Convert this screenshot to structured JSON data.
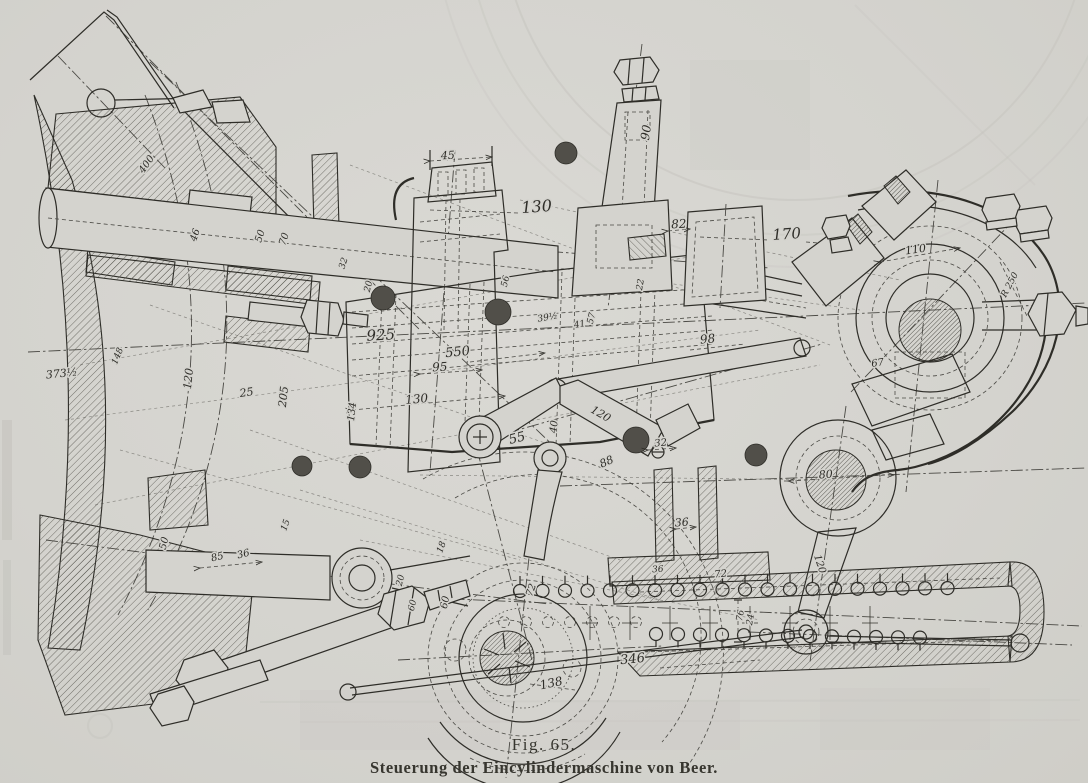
{
  "figure": {
    "number": "Fig. 65.",
    "caption": "Steuerung der Eincylindermaschine von Beer."
  },
  "colors": {
    "paper": "#d4d3ce",
    "ink": "#2e2d28",
    "faint": "#bcbbb4"
  },
  "diagram": {
    "type": "technical-drawing",
    "dimension_labels": [
      {
        "t": "45",
        "x": 448,
        "y": 159,
        "r": -3,
        "s": 11
      },
      {
        "t": "130",
        "x": 537,
        "y": 212,
        "r": -4,
        "s": 16
      },
      {
        "t": "82",
        "x": 679,
        "y": 228,
        "r": -3,
        "s": 12
      },
      {
        "t": "90",
        "x": 650,
        "y": 133,
        "r": -82,
        "s": 12
      },
      {
        "t": "170",
        "x": 787,
        "y": 239,
        "r": -4,
        "s": 15
      },
      {
        "t": "110",
        "x": 916,
        "y": 253,
        "r": -8,
        "s": 11
      },
      {
        "t": "R 250",
        "x": 1012,
        "y": 286,
        "r": -62,
        "s": 9
      },
      {
        "t": "925",
        "x": 381,
        "y": 340,
        "r": -3,
        "s": 15
      },
      {
        "t": "550",
        "x": 458,
        "y": 356,
        "r": -6,
        "s": 13
      },
      {
        "t": "95",
        "x": 440,
        "y": 371,
        "r": -3,
        "s": 12
      },
      {
        "t": "130",
        "x": 417,
        "y": 403,
        "r": -5,
        "s": 12
      },
      {
        "t": "134",
        "x": 355,
        "y": 412,
        "r": -84,
        "s": 10
      },
      {
        "t": "373½",
        "x": 62,
        "y": 377,
        "r": -6,
        "s": 11
      },
      {
        "t": "148",
        "x": 120,
        "y": 357,
        "r": -68,
        "s": 9
      },
      {
        "t": "120",
        "x": 192,
        "y": 379,
        "r": -84,
        "s": 11
      },
      {
        "t": "25",
        "x": 247,
        "y": 396,
        "r": -8,
        "s": 11
      },
      {
        "t": "205",
        "x": 287,
        "y": 397,
        "r": -84,
        "s": 11
      },
      {
        "t": "46",
        "x": 198,
        "y": 236,
        "r": -72,
        "s": 10
      },
      {
        "t": "50",
        "x": 263,
        "y": 237,
        "r": -72,
        "s": 10
      },
      {
        "t": "70",
        "x": 287,
        "y": 240,
        "r": -72,
        "s": 10
      },
      {
        "t": "32",
        "x": 346,
        "y": 264,
        "r": -72,
        "s": 9
      },
      {
        "t": "400",
        "x": 149,
        "y": 166,
        "r": -55,
        "s": 10
      },
      {
        "t": "20",
        "x": 371,
        "y": 287,
        "r": -76,
        "s": 9
      },
      {
        "t": "56",
        "x": 508,
        "y": 282,
        "r": -76,
        "s": 9
      },
      {
        "t": "39½",
        "x": 548,
        "y": 320,
        "r": -10,
        "s": 9
      },
      {
        "t": "41",
        "x": 580,
        "y": 327,
        "r": -10,
        "s": 9
      },
      {
        "t": "57",
        "x": 594,
        "y": 319,
        "r": -76,
        "s": 9
      },
      {
        "t": "22",
        "x": 643,
        "y": 285,
        "r": -80,
        "s": 9
      },
      {
        "t": "98",
        "x": 708,
        "y": 343,
        "r": -6,
        "s": 12
      },
      {
        "t": "120",
        "x": 599,
        "y": 417,
        "r": 30,
        "s": 11
      },
      {
        "t": "40",
        "x": 557,
        "y": 427,
        "r": -84,
        "s": 10
      },
      {
        "t": "55",
        "x": 518,
        "y": 442,
        "r": -14,
        "s": 13
      },
      {
        "t": "88",
        "x": 608,
        "y": 465,
        "r": -24,
        "s": 11
      },
      {
        "t": "32",
        "x": 661,
        "y": 446,
        "r": -6,
        "s": 10
      },
      {
        "t": "36",
        "x": 682,
        "y": 526,
        "r": -4,
        "s": 11
      },
      {
        "t": "80",
        "x": 826,
        "y": 478,
        "r": -4,
        "s": 11
      },
      {
        "t": "67",
        "x": 878,
        "y": 366,
        "r": -8,
        "s": 10
      },
      {
        "t": "120",
        "x": 817,
        "y": 565,
        "r": 72,
        "s": 10
      },
      {
        "t": "36",
        "x": 658,
        "y": 572,
        "r": -4,
        "s": 9
      },
      {
        "t": "72",
        "x": 721,
        "y": 577,
        "r": -6,
        "s": 10
      },
      {
        "t": "18",
        "x": 444,
        "y": 548,
        "r": -70,
        "s": 9
      },
      {
        "t": "60",
        "x": 448,
        "y": 603,
        "r": -78,
        "s": 10
      },
      {
        "t": "72",
        "x": 534,
        "y": 591,
        "r": -70,
        "s": 10
      },
      {
        "t": "346",
        "x": 633,
        "y": 663,
        "r": -6,
        "s": 13
      },
      {
        "t": "138",
        "x": 552,
        "y": 687,
        "r": -12,
        "s": 12
      },
      {
        "t": "76",
        "x": 743,
        "y": 616,
        "r": -80,
        "s": 9
      },
      {
        "t": "24",
        "x": 753,
        "y": 620,
        "r": -80,
        "s": 9
      },
      {
        "t": "50",
        "x": 167,
        "y": 544,
        "r": -76,
        "s": 10
      },
      {
        "t": "85",
        "x": 218,
        "y": 560,
        "r": -14,
        "s": 10
      },
      {
        "t": "36",
        "x": 244,
        "y": 557,
        "r": -14,
        "s": 10
      },
      {
        "t": "15",
        "x": 288,
        "y": 526,
        "r": -70,
        "s": 9
      },
      {
        "t": "20",
        "x": 403,
        "y": 581,
        "r": -76,
        "s": 9
      },
      {
        "t": "60",
        "x": 415,
        "y": 606,
        "r": -76,
        "s": 9
      }
    ]
  }
}
